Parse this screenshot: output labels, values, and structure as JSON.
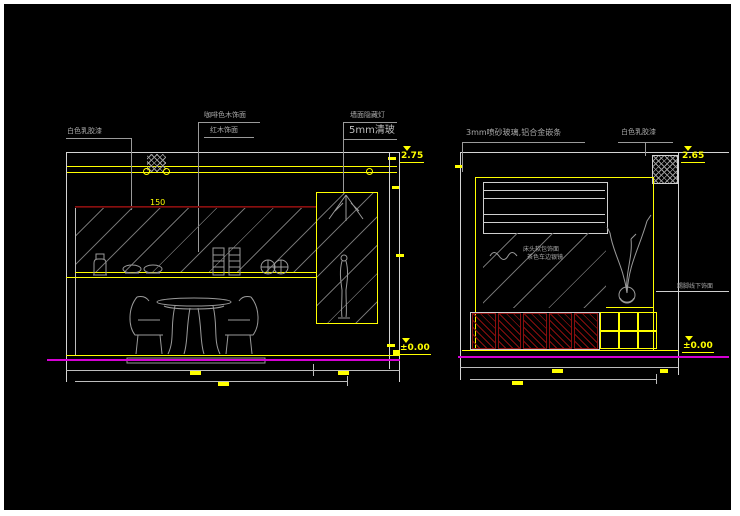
{
  "colors": {
    "background": "#000000",
    "frame": "#ffffff",
    "line_white": "#d4d4d4",
    "line_gray": "#9a9a9a",
    "accent_yellow": "#ffff00",
    "accent_magenta": "#d400d4",
    "accent_dark_red": "#8a0f0f"
  },
  "left_elevation": {
    "labels": {
      "paint": "白色乳胶漆",
      "wood_finish": "咖啡色木饰面",
      "wood_trim": "红木饰面",
      "hidden_light": "墙面隐藏灯",
      "glass": "5mm清玻"
    },
    "dimensions": {
      "crown_offset": "150",
      "level_top": "2.75",
      "level_bottom": "±0.00"
    }
  },
  "right_elevation": {
    "labels": {
      "frosted_glass": "3mm喷砂玻璃,铝合金嵌条",
      "paint": "白色乳胶漆",
      "mirror_note_line1": "床头软包饰面",
      "mirror_note_line2": "茶色车边银镜",
      "skirting_note": "踢脚线下饰面"
    },
    "dimensions": {
      "level_top": "2.65",
      "level_bottom": "±0.00"
    }
  }
}
